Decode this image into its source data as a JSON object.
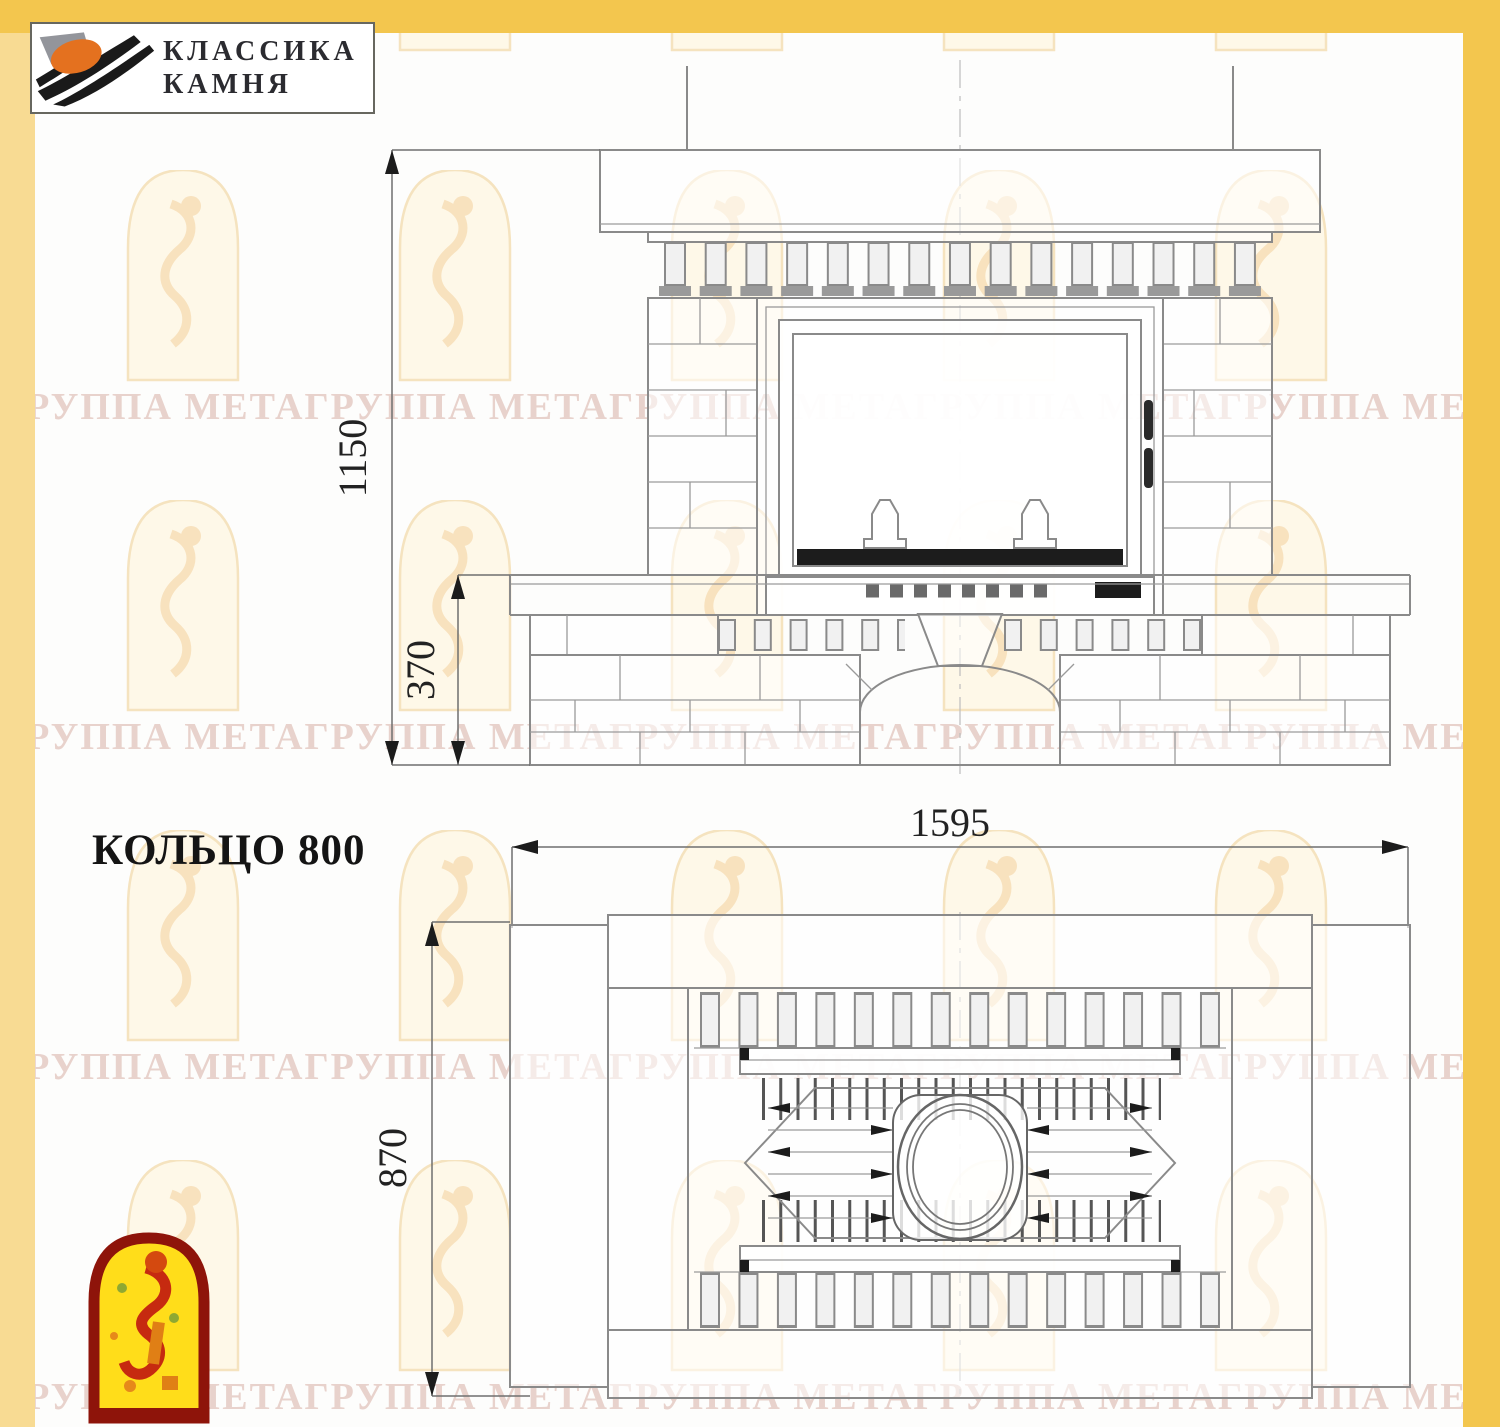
{
  "colors": {
    "frame_gold": "#F3C64E",
    "frame_gold_pale": "#F8DB93",
    "watermark_pink": "#E8D2CC",
    "watermark_arch_fill": "#FEF8E8",
    "watermark_arch_line": "#F5E3BF",
    "drawing_line_gray": "#8A8A8A",
    "ink": "#1B1B1B",
    "mascot_red": "#8E140A",
    "mascot_yellow": "#FFDD1A",
    "logo_orange": "#E4711F"
  },
  "logo": {
    "line1": "КЛАССИКА",
    "line2": "КАМНЯ"
  },
  "title": "КОЛЬЦО 800",
  "watermark": {
    "text": "ГРУППА МЕТАГРУППА МЕТАГРУППА МЕТАГРУППА МЕТАГРУППА МЕТА"
  },
  "drawing": {
    "front": {
      "total_height_mm": "1150",
      "base_height_mm": "370"
    },
    "plan": {
      "width_mm": "1595",
      "depth_mm": "870"
    }
  }
}
